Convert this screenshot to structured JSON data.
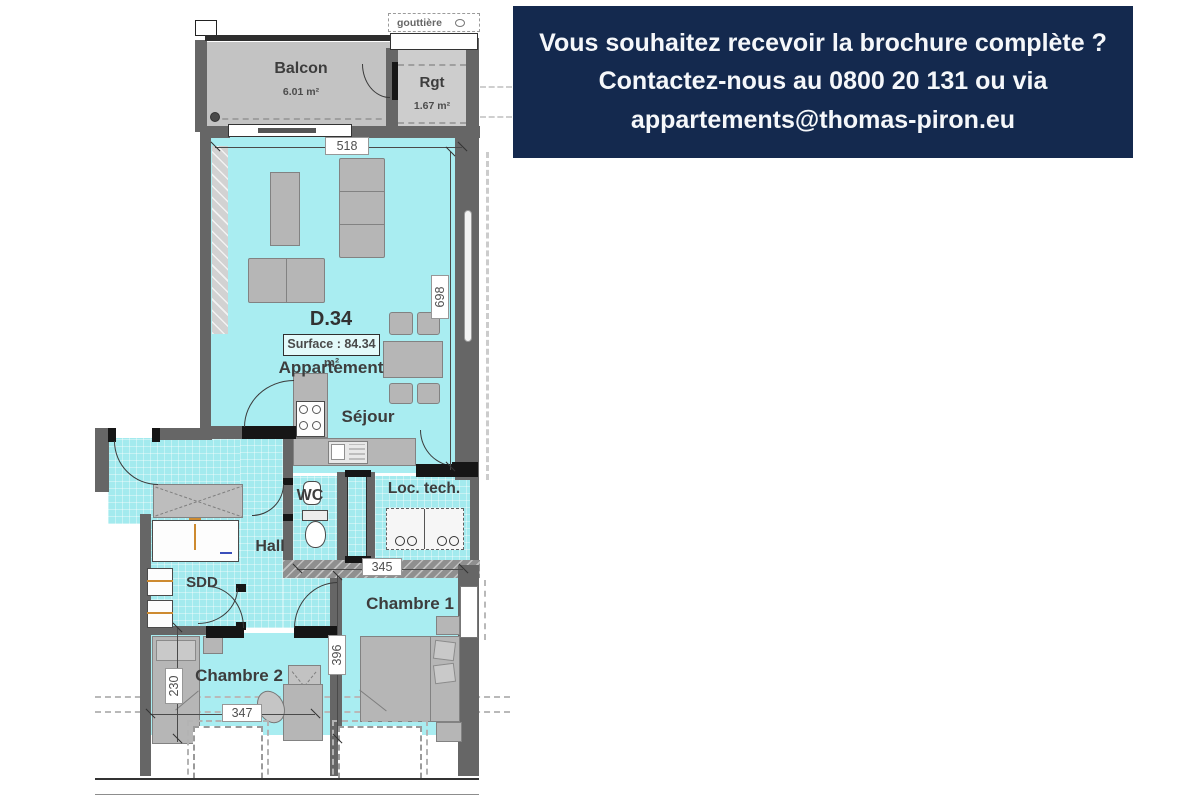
{
  "banner": {
    "bg_color": "#14294e",
    "text_color": "#f5f7fa",
    "lines": [
      "Vous souhaitez recevoir la brochure complète ?",
      "Contactez-nous au 0800 20 131 ou via",
      "appartements@thomas-piron.eu"
    ]
  },
  "plan": {
    "unit": {
      "code": "D.34",
      "surface_label": "Surface : 84.34 m²",
      "type_label": "Appartement"
    },
    "rooms": {
      "balcon": {
        "name": "Balcon",
        "area": "6.01 m²"
      },
      "rgt": {
        "name": "Rgt",
        "area": "1.67 m²"
      },
      "sejour": {
        "name": "Séjour"
      },
      "wc": {
        "name": "WC"
      },
      "loc_tech": {
        "name": "Loc. tech."
      },
      "hall": {
        "name": "Hall"
      },
      "sdd": {
        "name": "SDD"
      },
      "chambre1": {
        "name": "Chambre 1"
      },
      "chambre2": {
        "name": "Chambre 2"
      }
    },
    "annotations": {
      "gouttiere": "gouttière"
    },
    "dims": {
      "sejour_width": "518",
      "sejour_length": "698",
      "chambre1_width": "345",
      "chambre1_length": "396",
      "chambre2_length": "230",
      "chambre2_width": "347"
    },
    "colors": {
      "floor": "#a9edf1",
      "wall": "#666666",
      "balcony_floor": "#c3c3c3",
      "furniture": "#b6b6b6"
    }
  }
}
